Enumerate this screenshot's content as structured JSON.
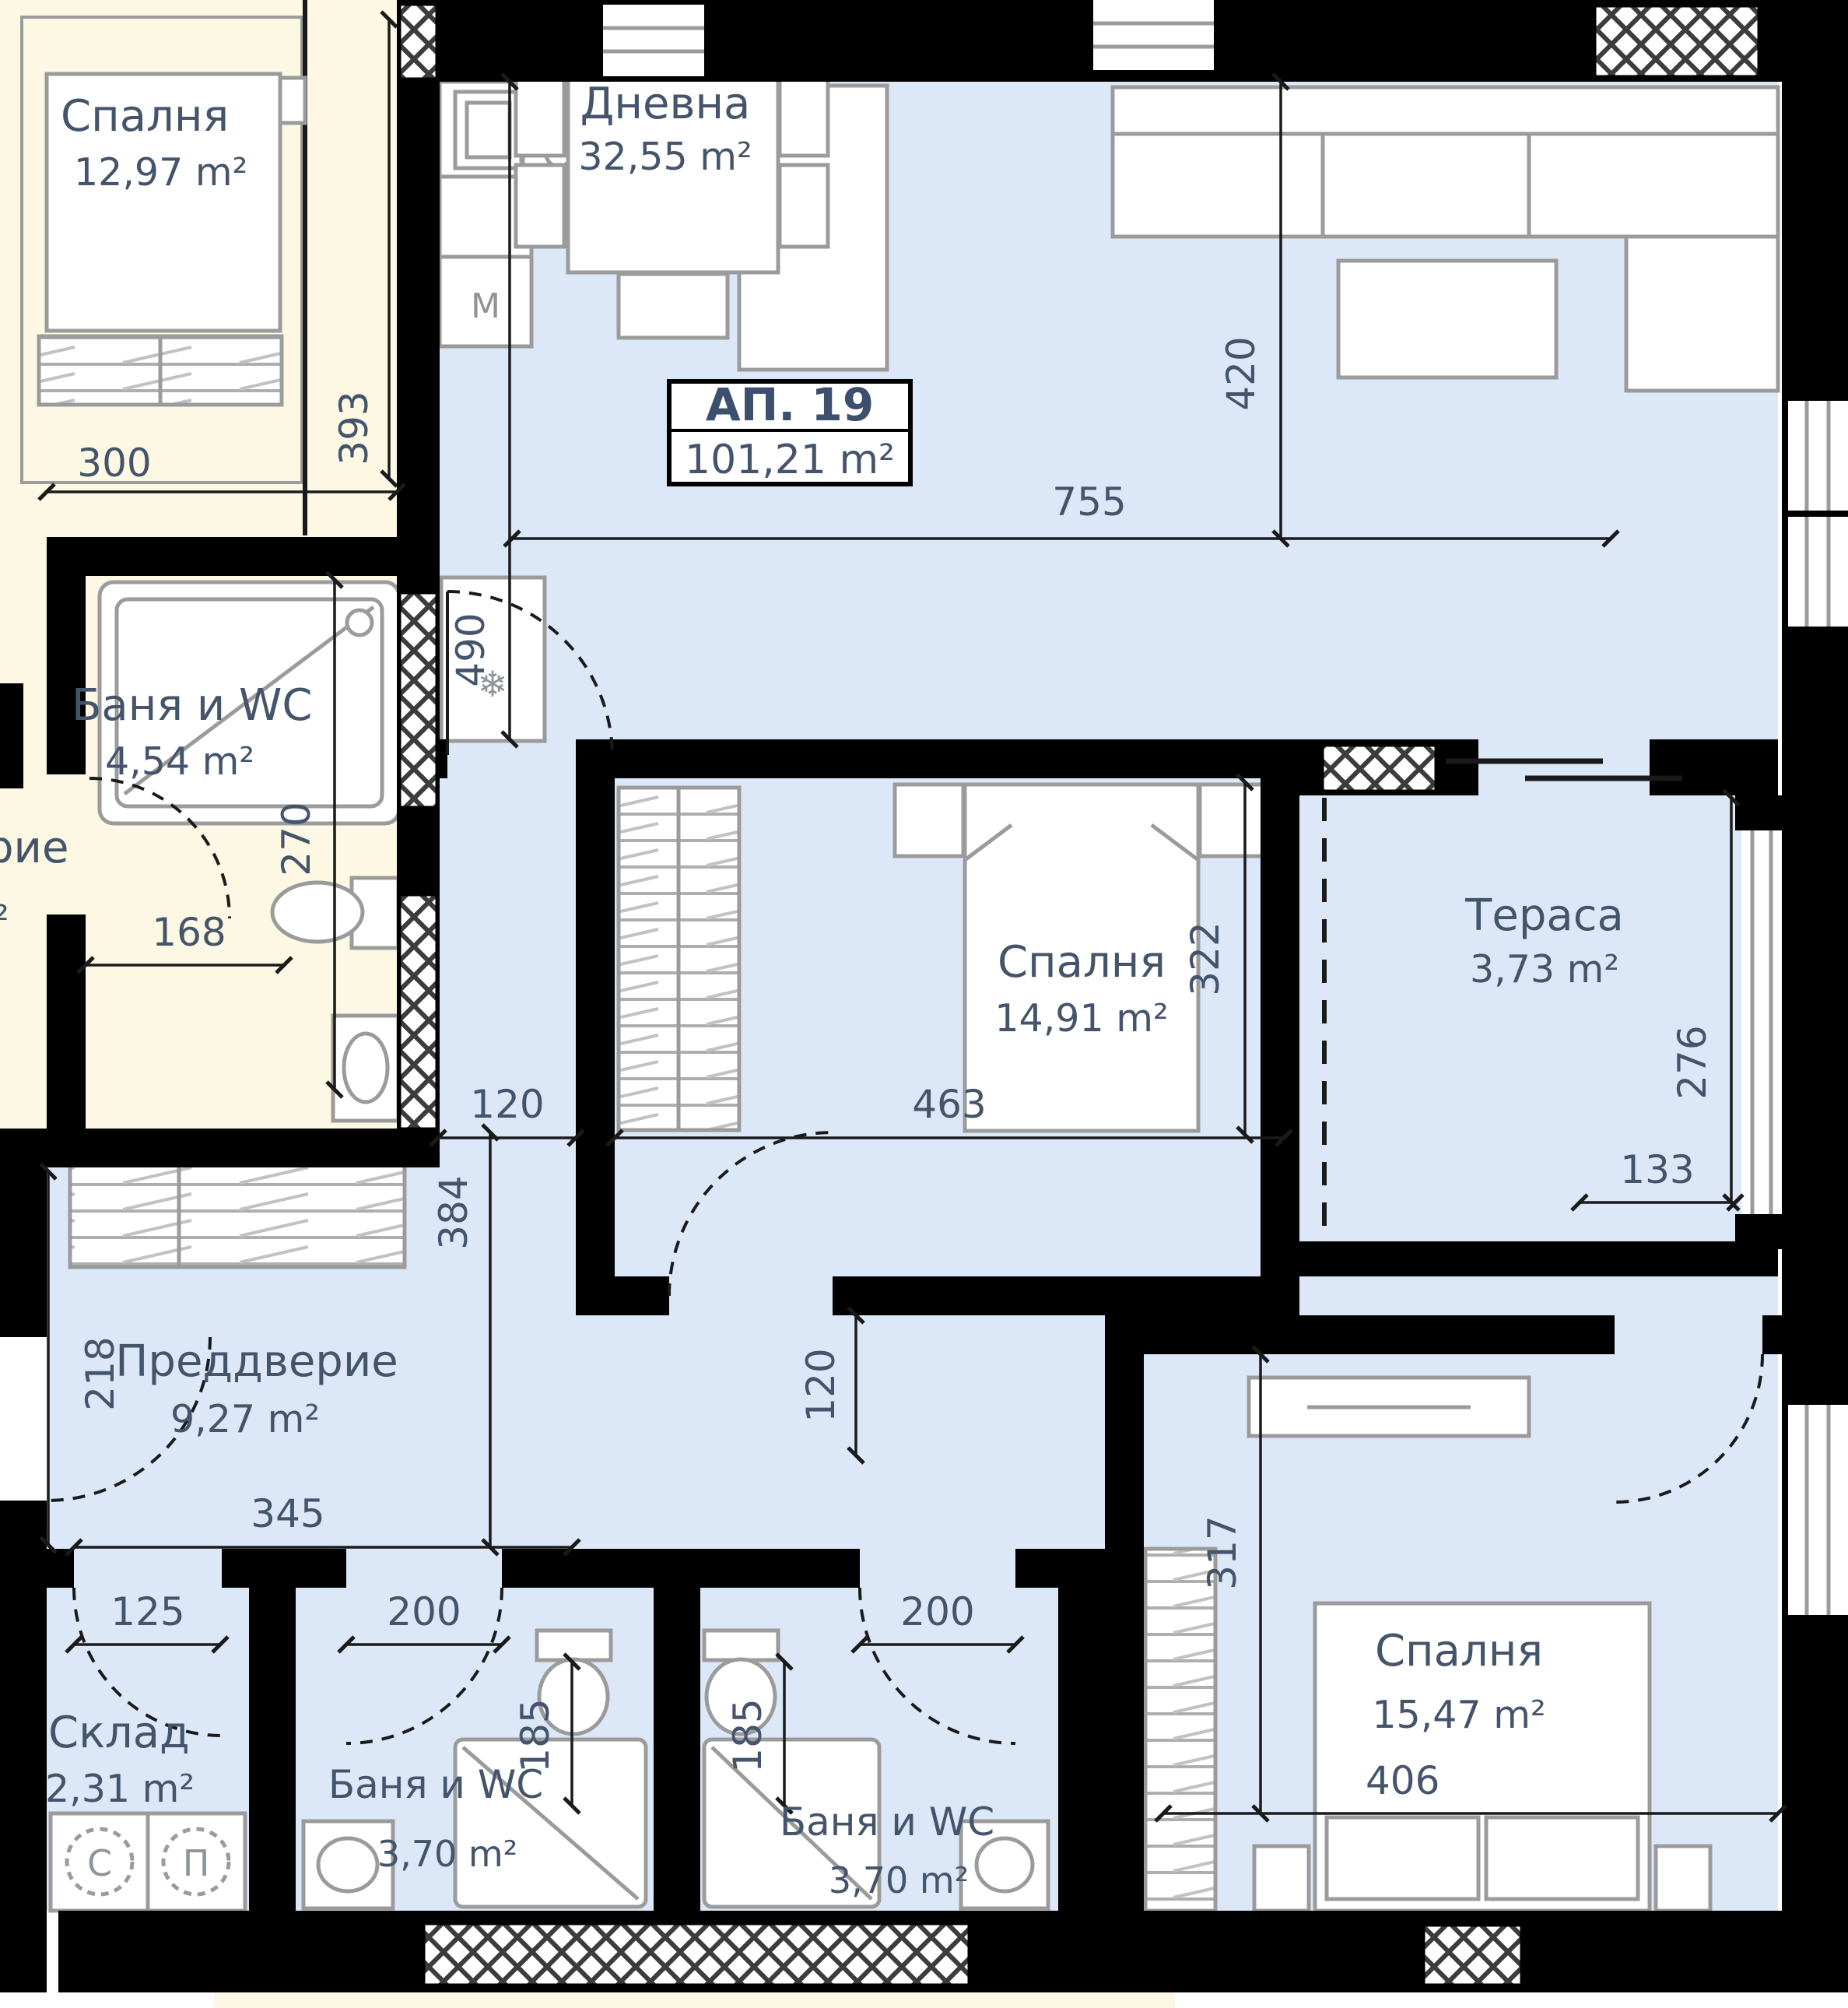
{
  "plan": {
    "unit_label": {
      "name": "АП. 19",
      "area": "101,21 m²"
    },
    "rooms": {
      "adj_bedroom": {
        "name": "Спалня",
        "area": "12,97 m²"
      },
      "adj_bath": {
        "name": "Баня и WC",
        "area": "4,54 m²"
      },
      "adj_partial": {
        "text": "рие",
        "text2": "м²"
      },
      "living": {
        "name": "Дневна",
        "area": "32,55 m²"
      },
      "bedroom_mid": {
        "name": "Спалня",
        "area": "14,91 m²"
      },
      "terrace": {
        "name": "Тераса",
        "area": "3,73 m²"
      },
      "hall": {
        "name": "Преддверие",
        "area": "9,27 m²"
      },
      "storage": {
        "name": "Склад",
        "area": "2,31 m²"
      },
      "bath1": {
        "name": "Баня и WC",
        "area": "3,70 m²"
      },
      "bath2": {
        "name": "Баня и WC",
        "area": "3,70 m²"
      },
      "bedroom_br": {
        "name": "Спалня",
        "area": "15,47 m²",
        "dim406": "406"
      }
    },
    "dims": {
      "d300": "300",
      "d393": "393",
      "d490": "490",
      "d755": "755",
      "d420": "420",
      "d270": "270",
      "d168": "168",
      "d120a": "120",
      "d463": "463",
      "d133": "133",
      "d322": "322",
      "d276": "276",
      "d384": "384",
      "d345": "345",
      "d218": "218",
      "d120b": "120",
      "d125": "125",
      "d200a": "200",
      "d185a": "185",
      "d200b": "200",
      "d185b": "185",
      "d317": "317"
    },
    "symbols": {
      "washer": "С",
      "dryer": "П",
      "appliance": "М",
      "fridge": "❄"
    },
    "colors": {
      "apartment_fill": "#dce8f8",
      "adjacent_fill": "#fcf8e3",
      "wall": "#000000",
      "furniture_stroke": "#9b9b9b",
      "label_text": "#44546b"
    }
  }
}
